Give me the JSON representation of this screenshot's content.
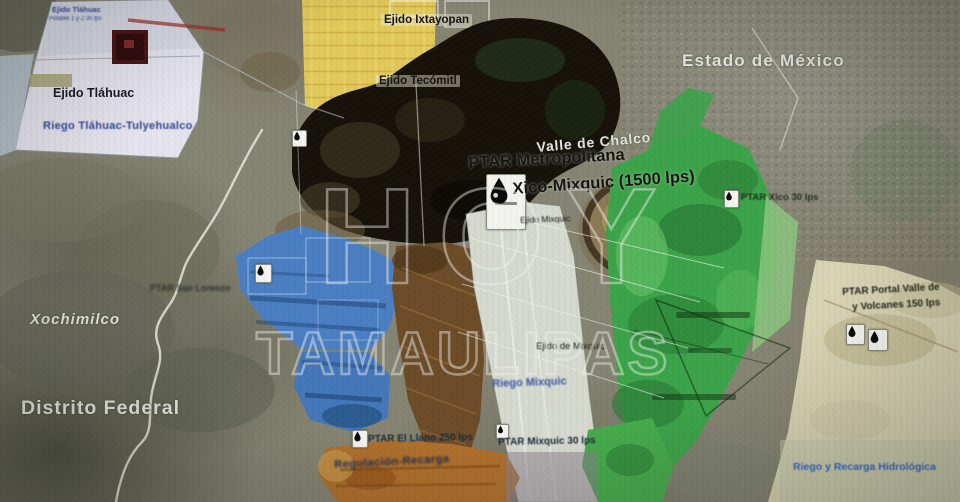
{
  "map": {
    "title": "Mapa de plantas de tratamiento (PTAR) zona Tláhuac-Mixquic-Valle de Chalco",
    "watermark": {
      "line1": "HOY",
      "line2": "TAMAULIPAS"
    },
    "labels": {
      "estado_de_mexico": "Estado de México",
      "valle_de_chalco": "Valle de Chalco",
      "ptar_metropolitana_1": "PTAR Metropolitana",
      "ptar_metropolitana_2": "Xico-Mixquic (1500 lps)",
      "ejido_mixquic_small": "Ejido Mixquic",
      "ejido_ixtayopan": "Ejido Ixtayopan",
      "ejido_tecomitl": "Ejido Tecómitl",
      "ejido_tlahuac_tiny_1": "Ejido Tláhuac",
      "ejido_tlahuac_tiny_2": "Potable 1 y 2  30 lps",
      "ejido_tlahuac": "Ejido Tláhuac",
      "riego_tlahuac": "Riego Tláhuac-Tulyehualco",
      "xochimilco": "Xochimilco",
      "distrito_federal": "Distrito Federal",
      "ptar_xico": "PTAR Xico 30 lps",
      "ptar_portal_1": "PTAR Portal Valle de",
      "ptar_portal_2": "y Volcanes 150 lps",
      "ptar_el_llano": "PTAR El Llano 250 lps",
      "ptar_mixquic": "PTAR Mixquic  30 lps",
      "ptar_oeste": "PTAR San Lorenzo",
      "ejido_de_mixquic": "Ejido de Mixquic",
      "riego_mixquic": "Riego Mixquic",
      "regulacion": "Regulación-Recarga",
      "riego_recarga": "Riego y Recarga Hidrológica"
    },
    "icons": {
      "water_drop": "💧"
    },
    "colors": {
      "riego_blue": "#4b7fc3",
      "green_zone": "#3ca44a",
      "yellow_urban": "#e3ca5a",
      "orange_zone": "#b0702c",
      "pale_east": "#d9d4b4",
      "label_blue": "#31479a",
      "watermark": "#eeeeec"
    }
  }
}
